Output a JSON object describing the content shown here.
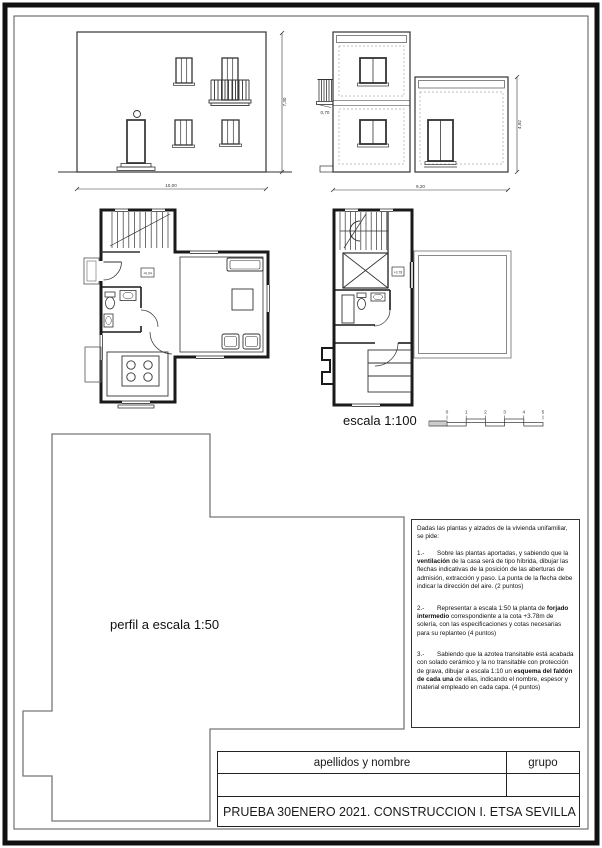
{
  "labels": {
    "escala": "escala 1:100",
    "perfil": "perfil a escala 1:50"
  },
  "scale_bar": {
    "numbers": [
      "0",
      "1",
      "2",
      "3",
      "4",
      "5"
    ]
  },
  "elevations": {
    "front": {
      "width_dim": "10,00",
      "height_dim": "7,30"
    },
    "side": {
      "width_dim": "9,20",
      "height_dim": "4,92",
      "balcony_dim": "0,70"
    }
  },
  "plans": {
    "ground": {
      "level": "+0.04"
    },
    "upper": {
      "level": "+3.78"
    }
  },
  "instructions": {
    "intro": "Dadas las plantas y alzados de la vivienda unifamiliar, se pide:",
    "item1": {
      "num": "1.-",
      "pre": "Sobre las plantas aportadas, y sabiendo que la ",
      "bold": "ventilación",
      "post": " de la casa será de tipo híbrida, dibujar las flechas indicativas de la posición de las aberturas de admisión, extracción y paso. La punta de la flecha debe indicar la dirección del aire. (2 puntos)"
    },
    "item2": {
      "num": "2.-",
      "pre": "Representar a escala 1:50 la planta de ",
      "bold": "forjado intermedio",
      "post": " correspondiente a la cota +3.78m de solería, con las especificaciones y cotas necesarias para su replanteo (4 puntos)"
    },
    "item3": {
      "num": "3.-",
      "pre": "Sabiendo que la azotea transitable está acabada con solado cerámico y la no transitable con protección de grava, dibujar a escala 1:10 un ",
      "bold": "esquema del faldón de cada una",
      "post": " de ellas, indicando el nombre, espesor y material empleado en cada capa.  (4 puntos)"
    }
  },
  "title_block": {
    "name_header": "apellidos y nombre",
    "group_header": "grupo",
    "exam_title": "PRUEBA 30ENERO 2021. CONSTRUCCION I. ETSA SEVILLA"
  }
}
